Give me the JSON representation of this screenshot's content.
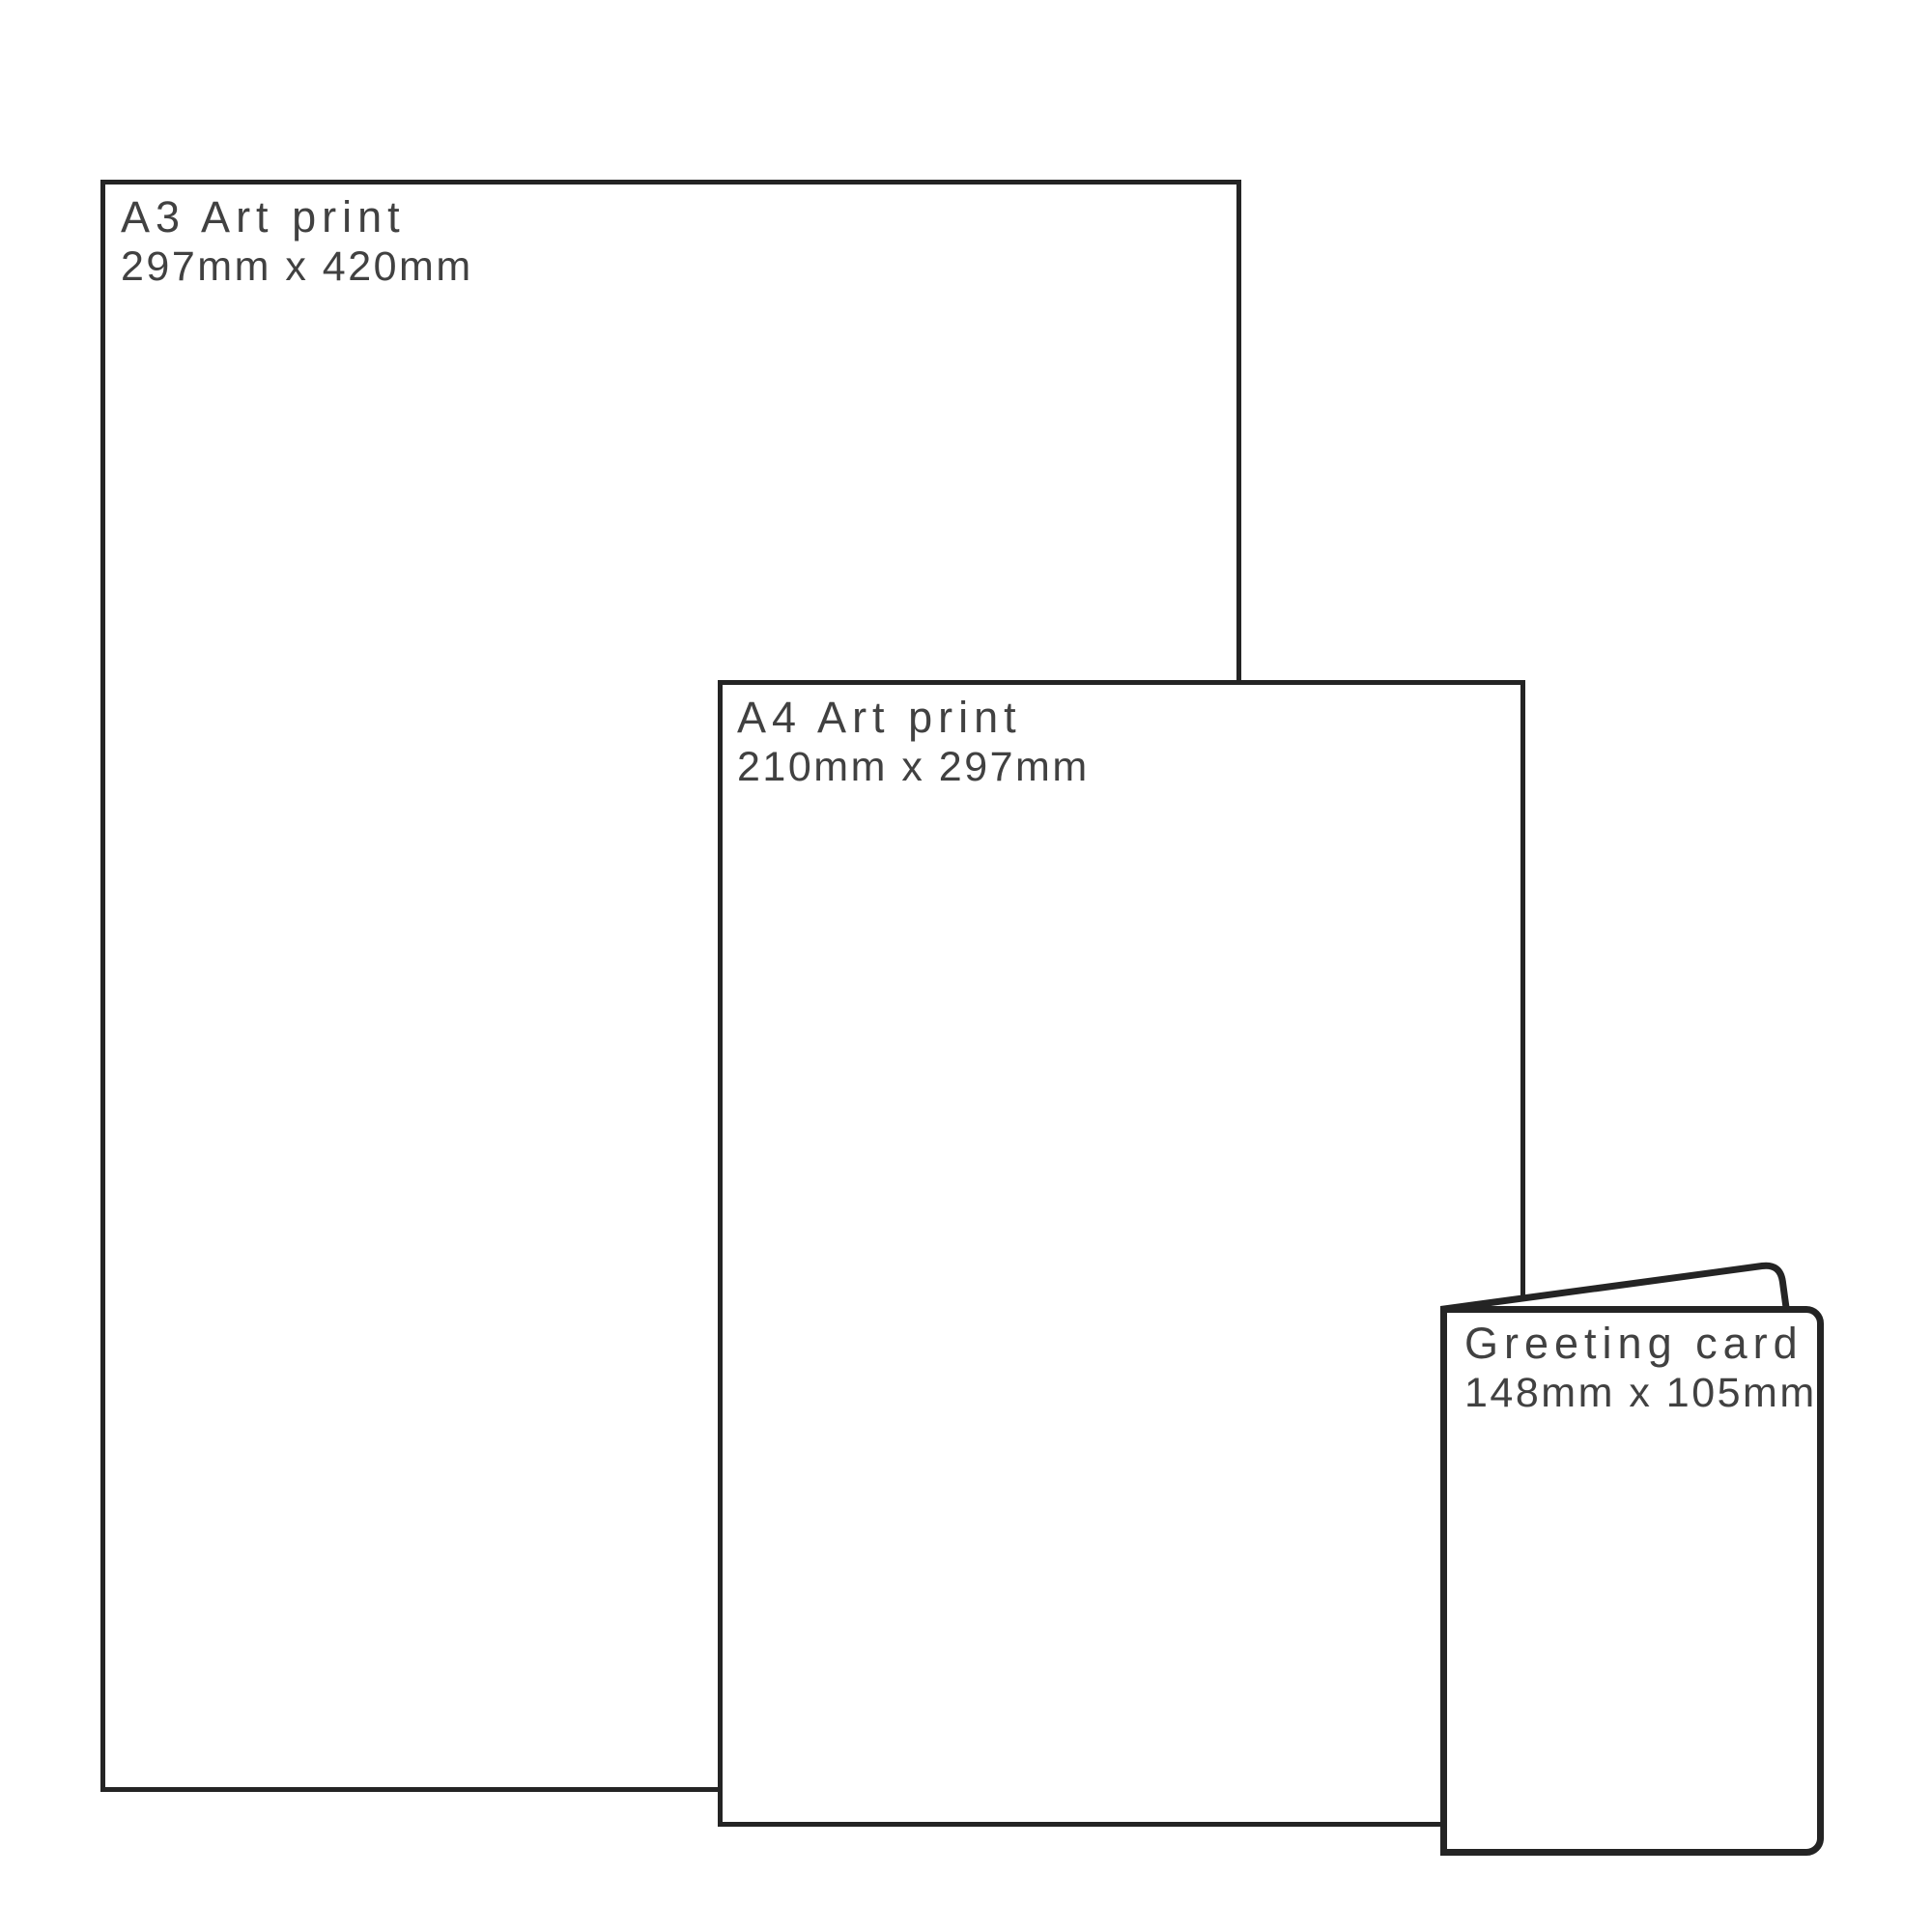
{
  "diagram": {
    "description": "Print product size comparison",
    "colors": {
      "background": "#ffffff",
      "outline": "#242424",
      "text": "#414141"
    },
    "items": [
      {
        "id": "a3-print",
        "name": "A3 Art print",
        "dimensions": "297mm x 420mm"
      },
      {
        "id": "a4-print",
        "name": "A4 Art print",
        "dimensions": "210mm x 297mm"
      },
      {
        "id": "greeting-card",
        "name": "Greeting card",
        "dimensions": "148mm x 105mm"
      }
    ]
  }
}
